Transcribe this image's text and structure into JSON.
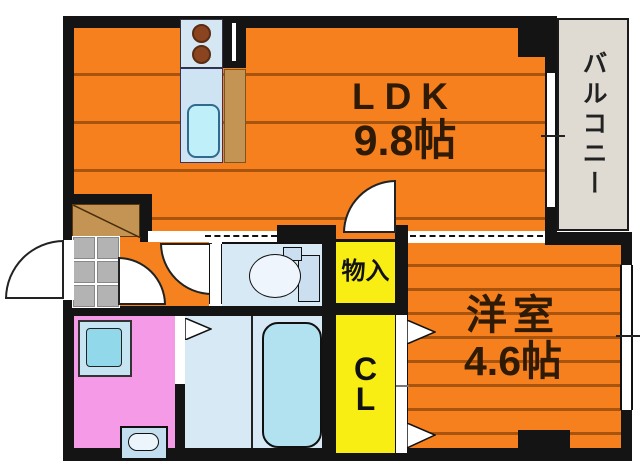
{
  "title": "apartment-floor-plan",
  "rooms": {
    "ldk": {
      "name": "LDK",
      "size": "9.8帖"
    },
    "bedroom": {
      "name": "洋室",
      "size": "4.6帖"
    },
    "balcony": {
      "name": "バルコニー"
    },
    "storage": {
      "name": "物入"
    },
    "closet": {
      "line1": "C",
      "line2": "L"
    }
  },
  "icons": [
    "entrance-door-arc",
    "interior-door-arc",
    "ldk-door-arc",
    "toilet-icon",
    "bathtub-icon",
    "washing-machine-icon",
    "wash-basin-icon",
    "stove-burners-icon",
    "kitchen-sink-icon",
    "refrigerator-icon",
    "shoe-cabinet-icon",
    "entrance-tiles-icon",
    "window-icon",
    "sliding-opening-dashed",
    "door-triangle-icon",
    "pillar"
  ],
  "colors": {
    "wall": "#141414",
    "floor_orange": "#F5801D",
    "floor_stripe": "#A8540E",
    "storage_yellow": "#F8EE13",
    "washroom_pink": "#F49AE6",
    "wet_room_blue": "#D8E9F6",
    "bathtub_blue": "#B2E2EF",
    "wood_tan": "#C49455",
    "balcony_gray": "#DFDBD3",
    "label_brown": "#2E1A05"
  }
}
